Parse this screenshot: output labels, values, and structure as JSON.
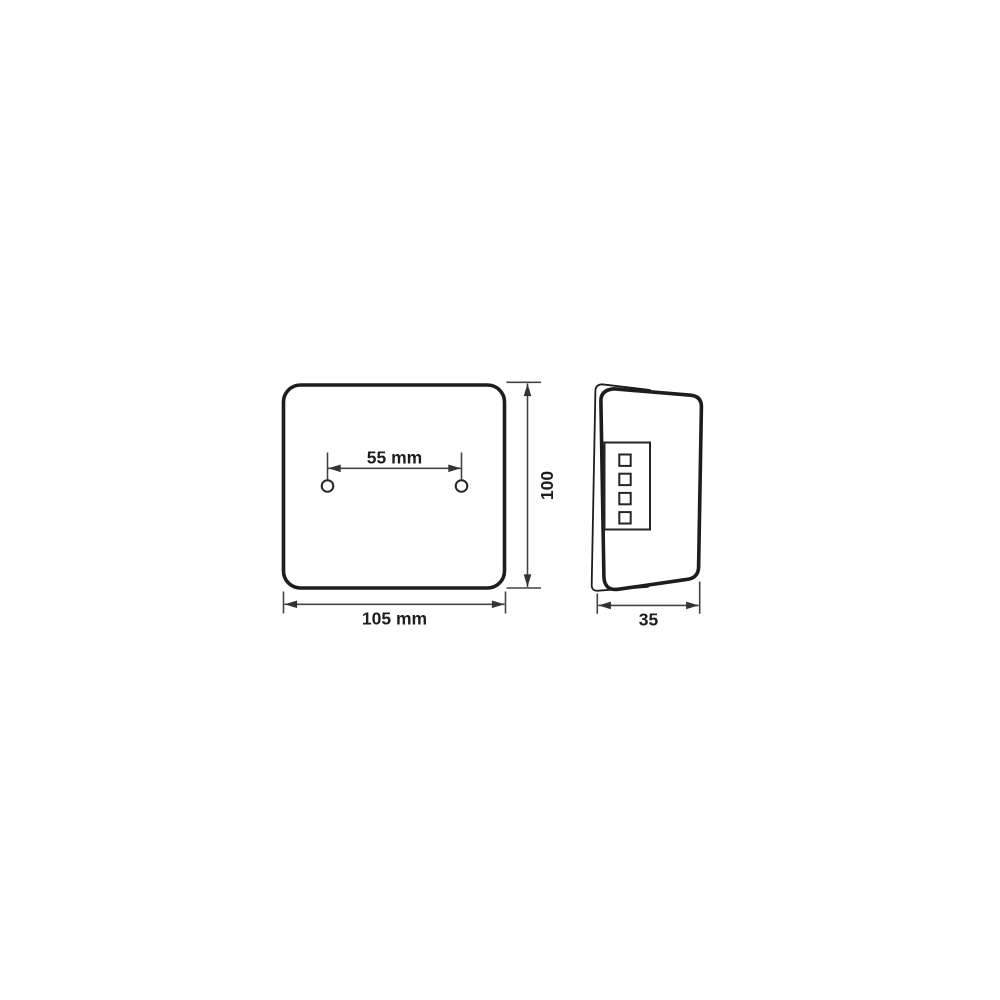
{
  "drawing": {
    "kind": "technical-dimension-diagram",
    "background": "#ffffff",
    "outline_color": "#1d1d1b",
    "dimension_line_color": "#444444",
    "text_color": "#1e1e1e",
    "front_view": {
      "name": "front-view",
      "label_hole_spacing": "55 mm",
      "label_height": "100",
      "label_width": "105 mm",
      "mounting_hole_count": 2
    },
    "side_view": {
      "name": "side-view",
      "label_depth": "35",
      "connector_pin_count": 4
    }
  }
}
